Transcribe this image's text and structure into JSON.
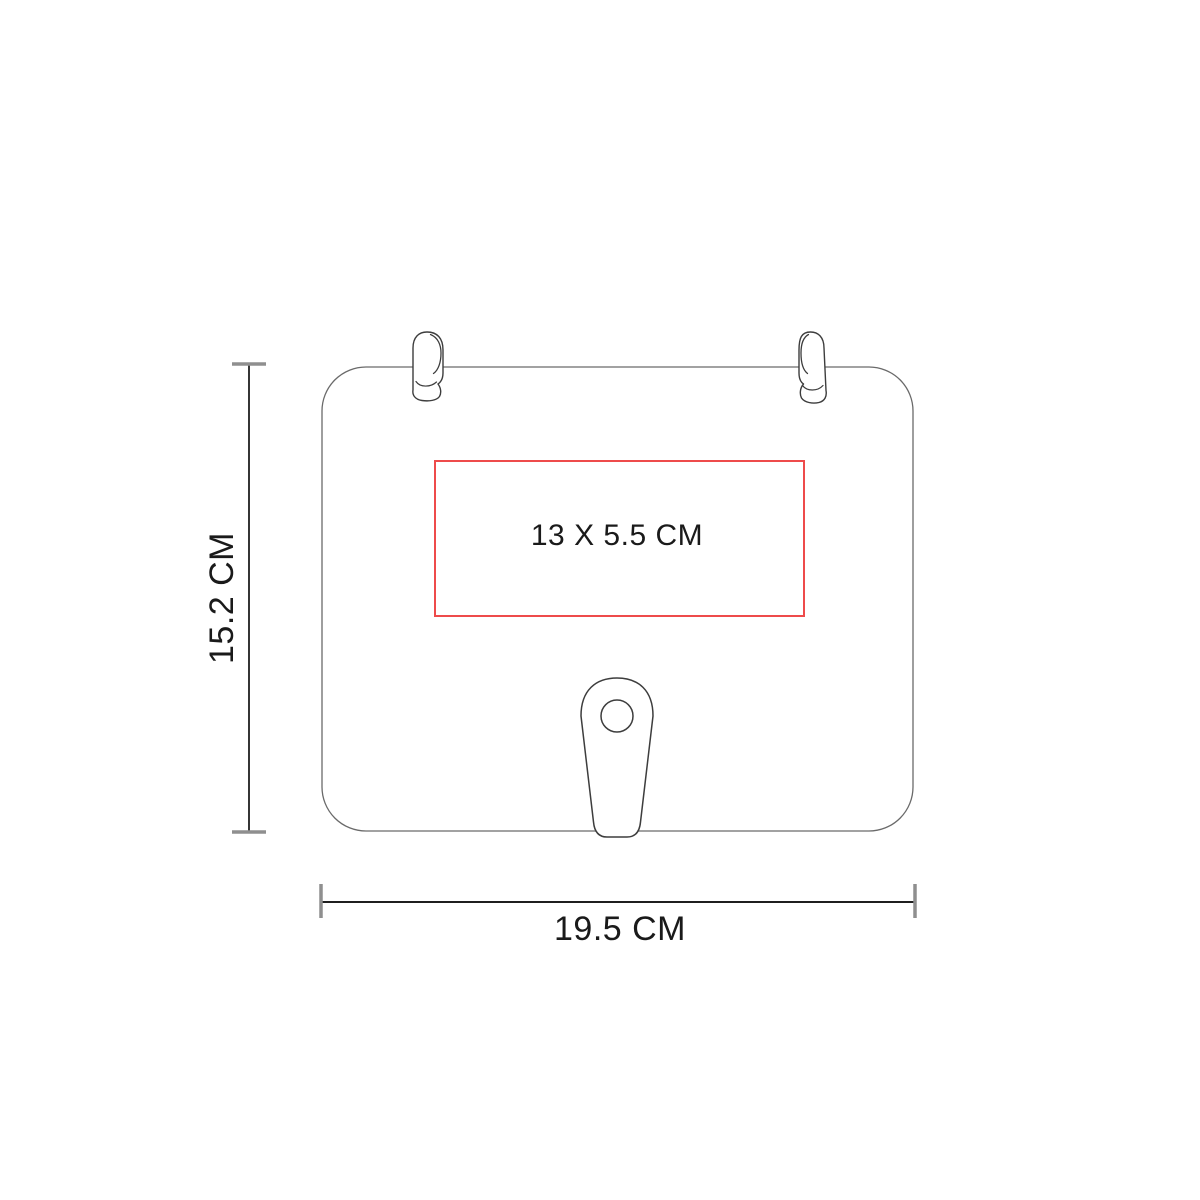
{
  "diagram": {
    "product": {
      "height_label": "15.2 CM",
      "width_label": "19.5 CM",
      "print_area_label": "13 X 5.5 CM"
    },
    "colors": {
      "print_area_red": "#ee4b4b",
      "body_outline_gray": "#6a6a6a",
      "detail_outline_dark": "#3d3d3d",
      "dimension_line_black": "#1f1f1f",
      "tick_gray": "#8f8f8f",
      "text_black": "#1a1a1a"
    }
  }
}
